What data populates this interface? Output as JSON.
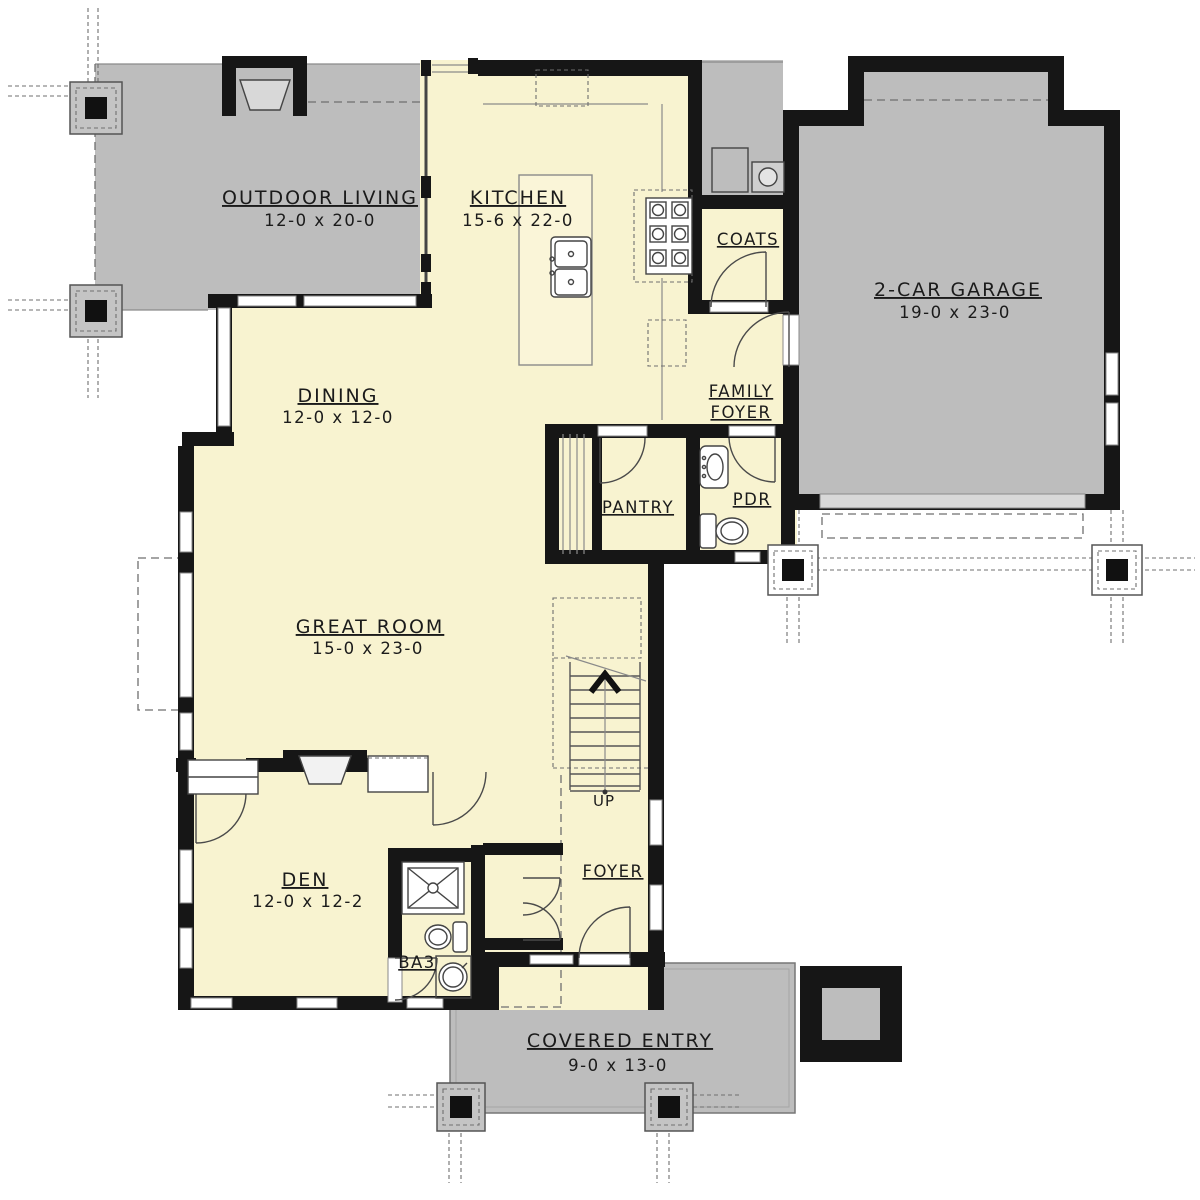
{
  "meta": {
    "type": "first-floor-plan"
  },
  "colors": {
    "floor": "#f8f3d0",
    "outdoor_concrete": "#bdbdbd",
    "wall": "#161616",
    "garage_apron": "#d8d8d8",
    "line": "#555555"
  },
  "rooms": {
    "outdoor_living": {
      "name": "OUTDOOR LIVING",
      "dims": "12-0 x 20-0"
    },
    "kitchen": {
      "name": "KITCHEN",
      "dims": "15-6 x 22-0"
    },
    "coats": {
      "name": "COATS"
    },
    "garage": {
      "name": "2-CAR GARAGE",
      "dims": "19-0 x 23-0"
    },
    "dining": {
      "name": "DINING",
      "dims": "12-0 x 12-0"
    },
    "family_foyer": {
      "line1": "FAMILY",
      "line2": "FOYER"
    },
    "pantry": {
      "name": "PANTRY"
    },
    "pdr": {
      "name": "PDR"
    },
    "great_room": {
      "name": "GREAT ROOM",
      "dims": "15-0 x 23-0"
    },
    "den": {
      "name": "DEN",
      "dims": "12-0 x 12-2"
    },
    "ba3": {
      "name": "BA3"
    },
    "foyer": {
      "name": "FOYER"
    },
    "covered_entry": {
      "name": "COVERED ENTRY",
      "dims": "9-0 x 13-0"
    },
    "stairs": {
      "label": "UP"
    }
  }
}
